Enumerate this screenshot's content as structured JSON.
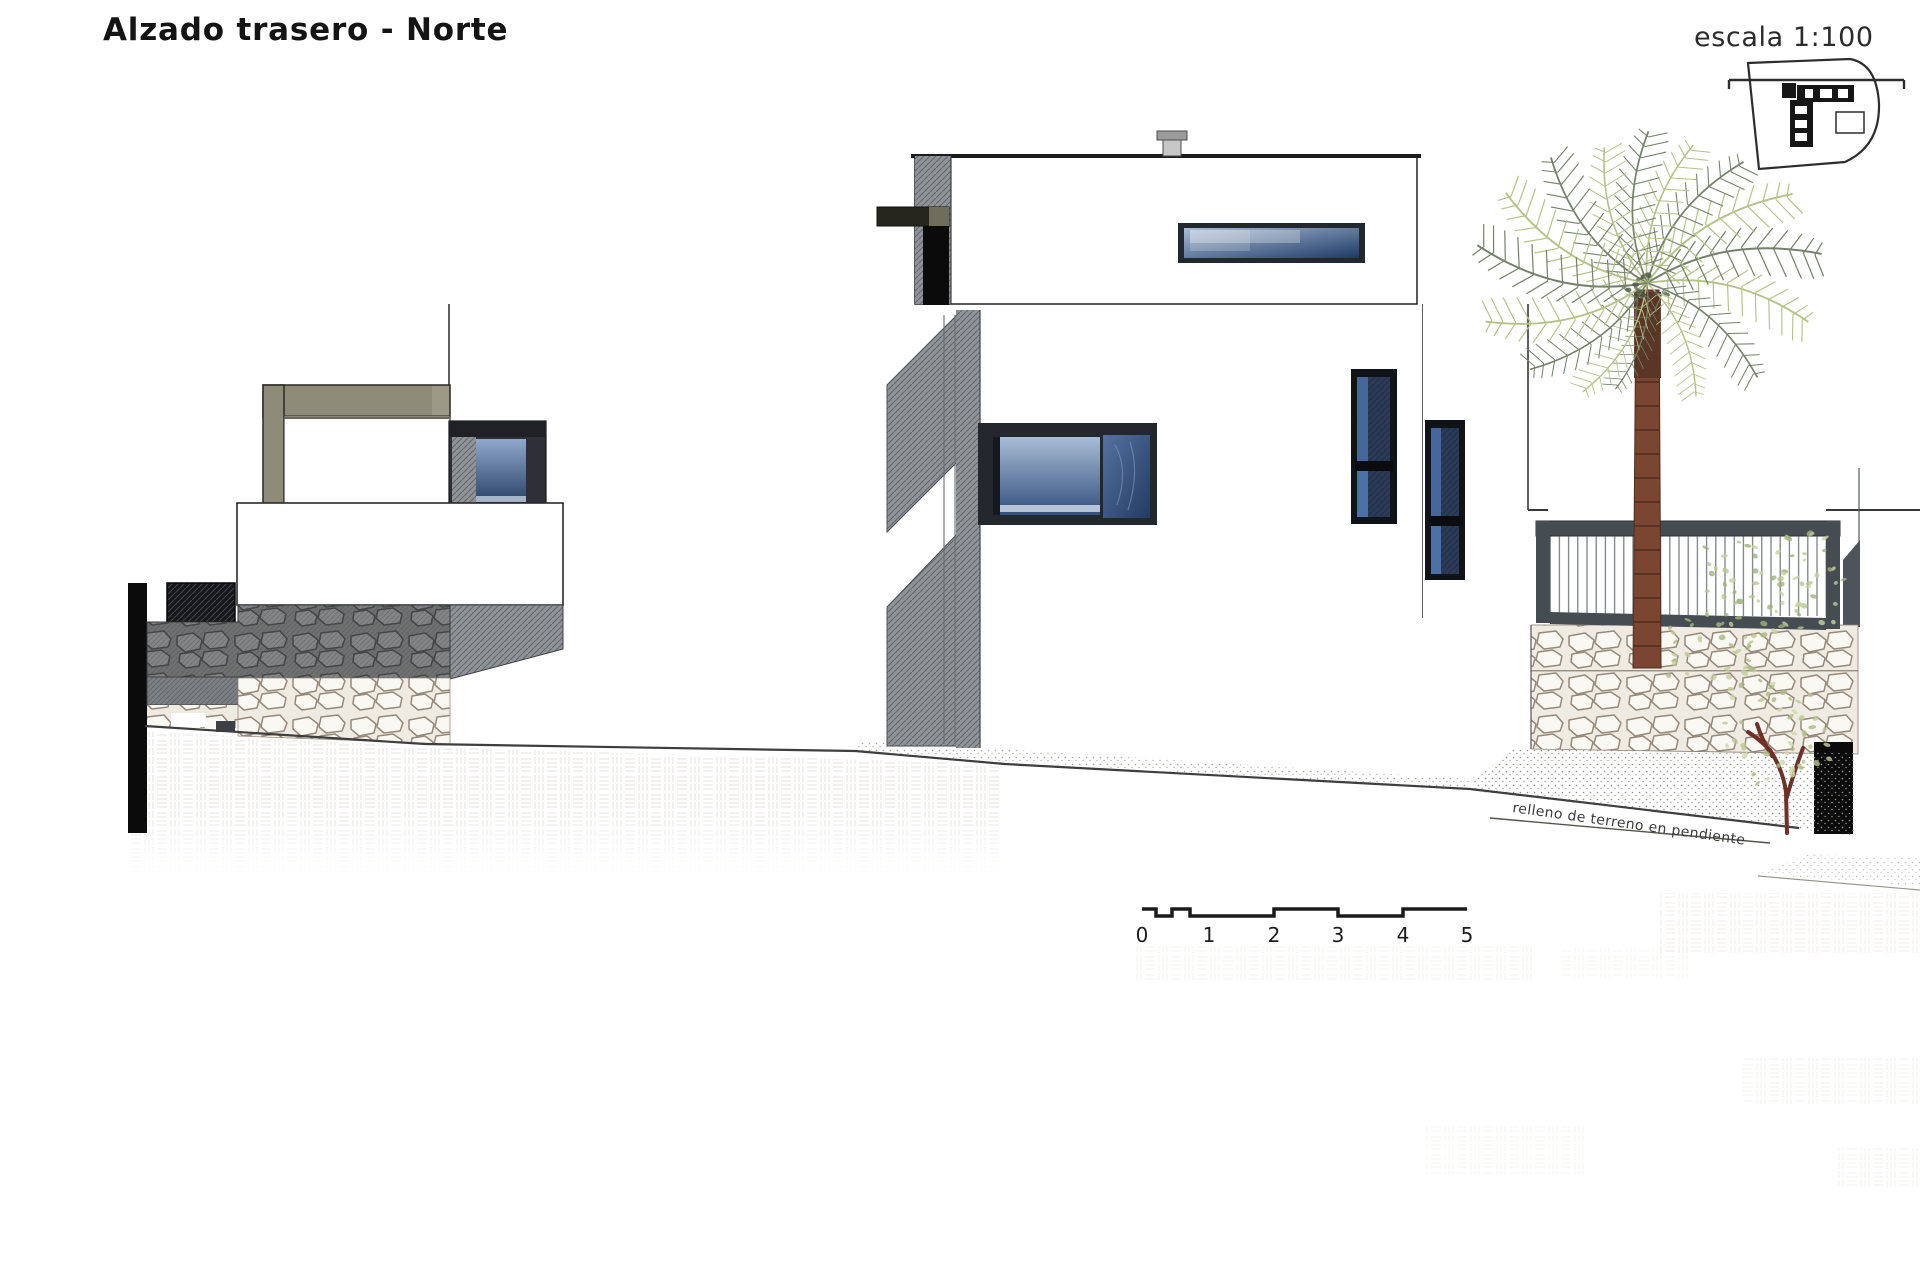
{
  "header": {
    "title": "Alzado trasero - Norte",
    "scale_label": "escala 1:100"
  },
  "drawing": {
    "terrain_annotation": "relleno de terreno en pendiente",
    "scale_bar": {
      "numbers": [
        "0",
        "1",
        "2",
        "3",
        "4",
        "5"
      ]
    },
    "colors": {
      "background": "#ffffff",
      "outline": "#2a2a2a",
      "facade_white": "#ffffff",
      "parapet_olive": "#8e8b79",
      "parapet_olive_light": "#9c9987",
      "window_frame_dark": "#23272e",
      "glass_light": "#a9bcd6",
      "glass_dark": "#33507d",
      "hatch_gray": "#8f9398",
      "stone_dark": "#6f7070",
      "stone_light": "#efebe3",
      "railing_gray": "#454c52",
      "palm_green_light": "#b5c287",
      "palm_green_dark": "#75816a",
      "trunk_brown": "#7a4632",
      "tree_branch": "#6e3028",
      "section_black": "#0b0b0b"
    }
  }
}
